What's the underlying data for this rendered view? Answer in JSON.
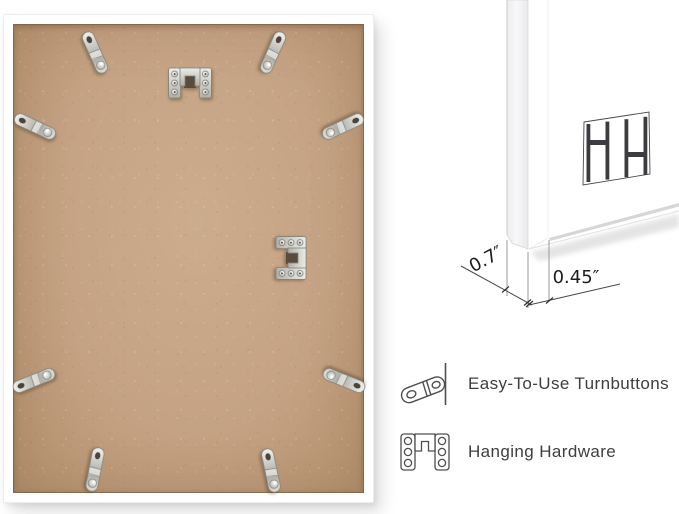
{
  "dimension_labels": {
    "depth": "0.7″",
    "face_width": "0.45″"
  },
  "features": [
    {
      "icon": "turnbutton-icon",
      "label": "Easy-To-Use Turnbuttons"
    },
    {
      "icon": "hanging-hardware-icon",
      "label": "Hanging Hardware"
    }
  ],
  "back_view": {
    "turnbutton_count": 8,
    "hanging_hardware_count": 2
  },
  "logo": {
    "icon": "hh-monogram-logo"
  },
  "colors": {
    "background": "#ffffff",
    "frame": "#ffffff",
    "mdf_board": "#c4a283",
    "metal_hardware": "#c9c9c4",
    "feature_text": "#3e3e3e",
    "dimension_text": "#1d1d1d",
    "icon_outline": "#4f4f4f"
  }
}
